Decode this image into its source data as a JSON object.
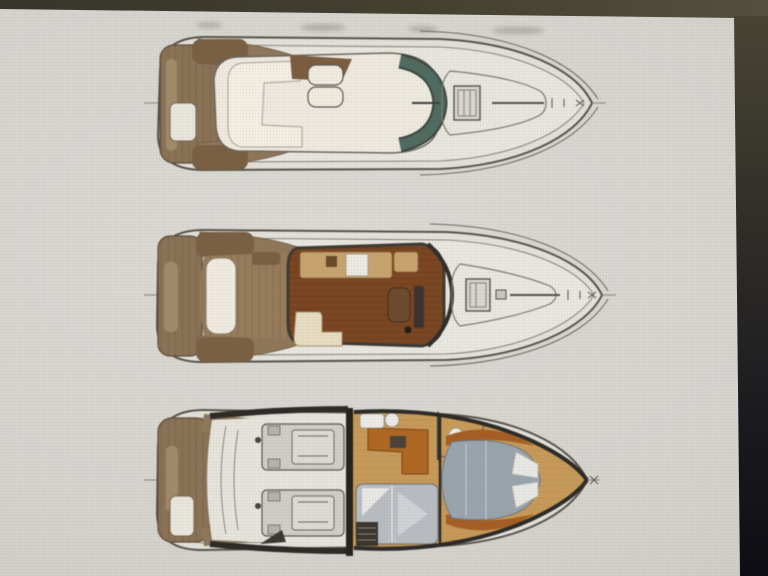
{
  "scene": {
    "description": "Photograph of a display showing three stacked top-view deck plans of a flybridge motor yacht (no text visible)",
    "views": [
      {
        "id": "flybridge-deck",
        "label": ""
      },
      {
        "id": "main-deck",
        "label": ""
      },
      {
        "id": "lower-deck",
        "label": ""
      }
    ],
    "colors": {
      "photo_background": "#d7d5d0",
      "surround_top_olive": "#46432f",
      "surround_right_dark": "#0d0d13",
      "hull_fill": "#e4e2db",
      "outline_dark": "#55524a",
      "teak_wood": "#8b7254",
      "teak_light": "#a28a67",
      "upholstery_cream": "#efeadf",
      "saloon_wood_floor": "#7c451f",
      "galley_counter_tan": "#c9a36b",
      "lower_deck_wood": "#b3661e",
      "cabin_floor_tan": "#c99a54",
      "berth_mattress_gray": "#9aa4ab",
      "windshield_glass_teal": "#4e6a60",
      "engine_gray": "#cfcfc8",
      "bulkhead_black": "#23221e"
    }
  }
}
